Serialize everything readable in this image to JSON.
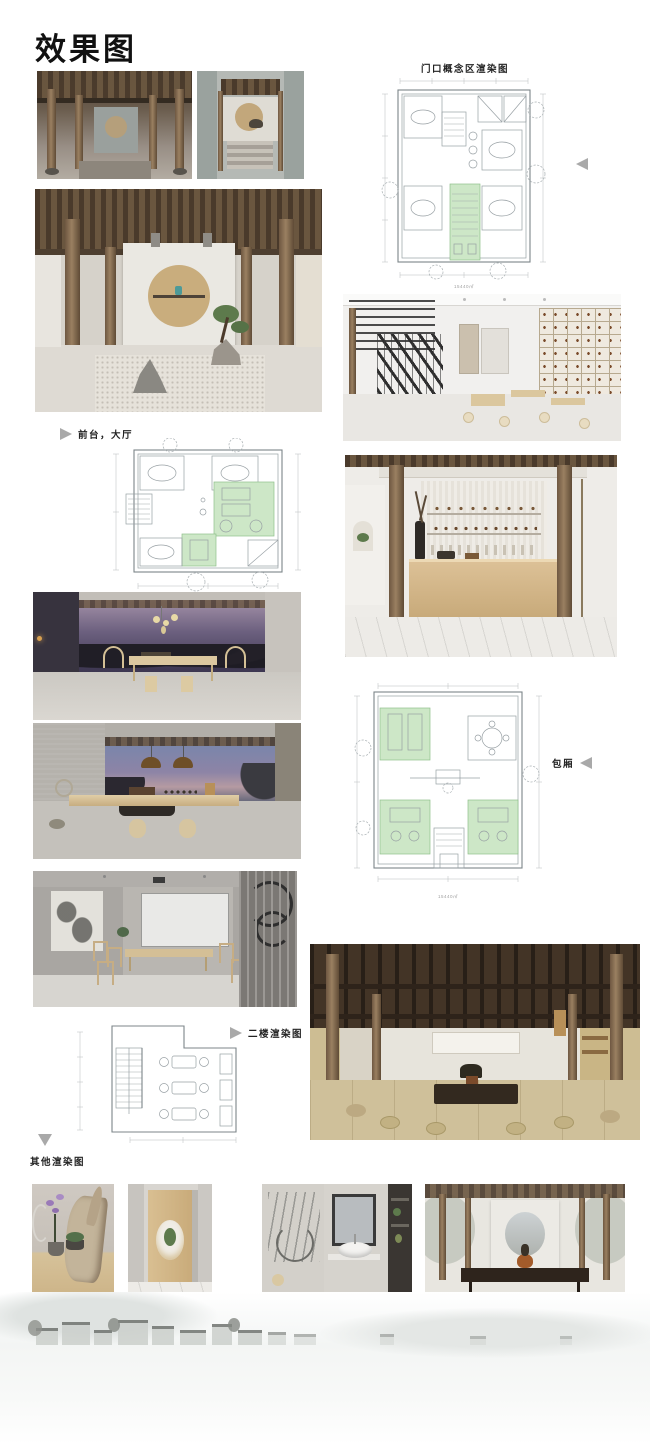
{
  "board": {
    "title": "效果图"
  },
  "labels": {
    "entrance_plan": "门口概念区渲染图",
    "lobby": "前台，大厅",
    "private_room": "包厢",
    "second_floor": "二楼渲染图",
    "others": "其他渲染图"
  },
  "captions": {
    "entrance_plan_dim": "15440㎡",
    "private_plan_dim": "15440㎡"
  },
  "colors": {
    "plan_highlight_green": "#cde7c7",
    "plan_line_gray": "#98a0a4",
    "pointer_gray": "#a9a9a9",
    "title_black": "#111111"
  }
}
